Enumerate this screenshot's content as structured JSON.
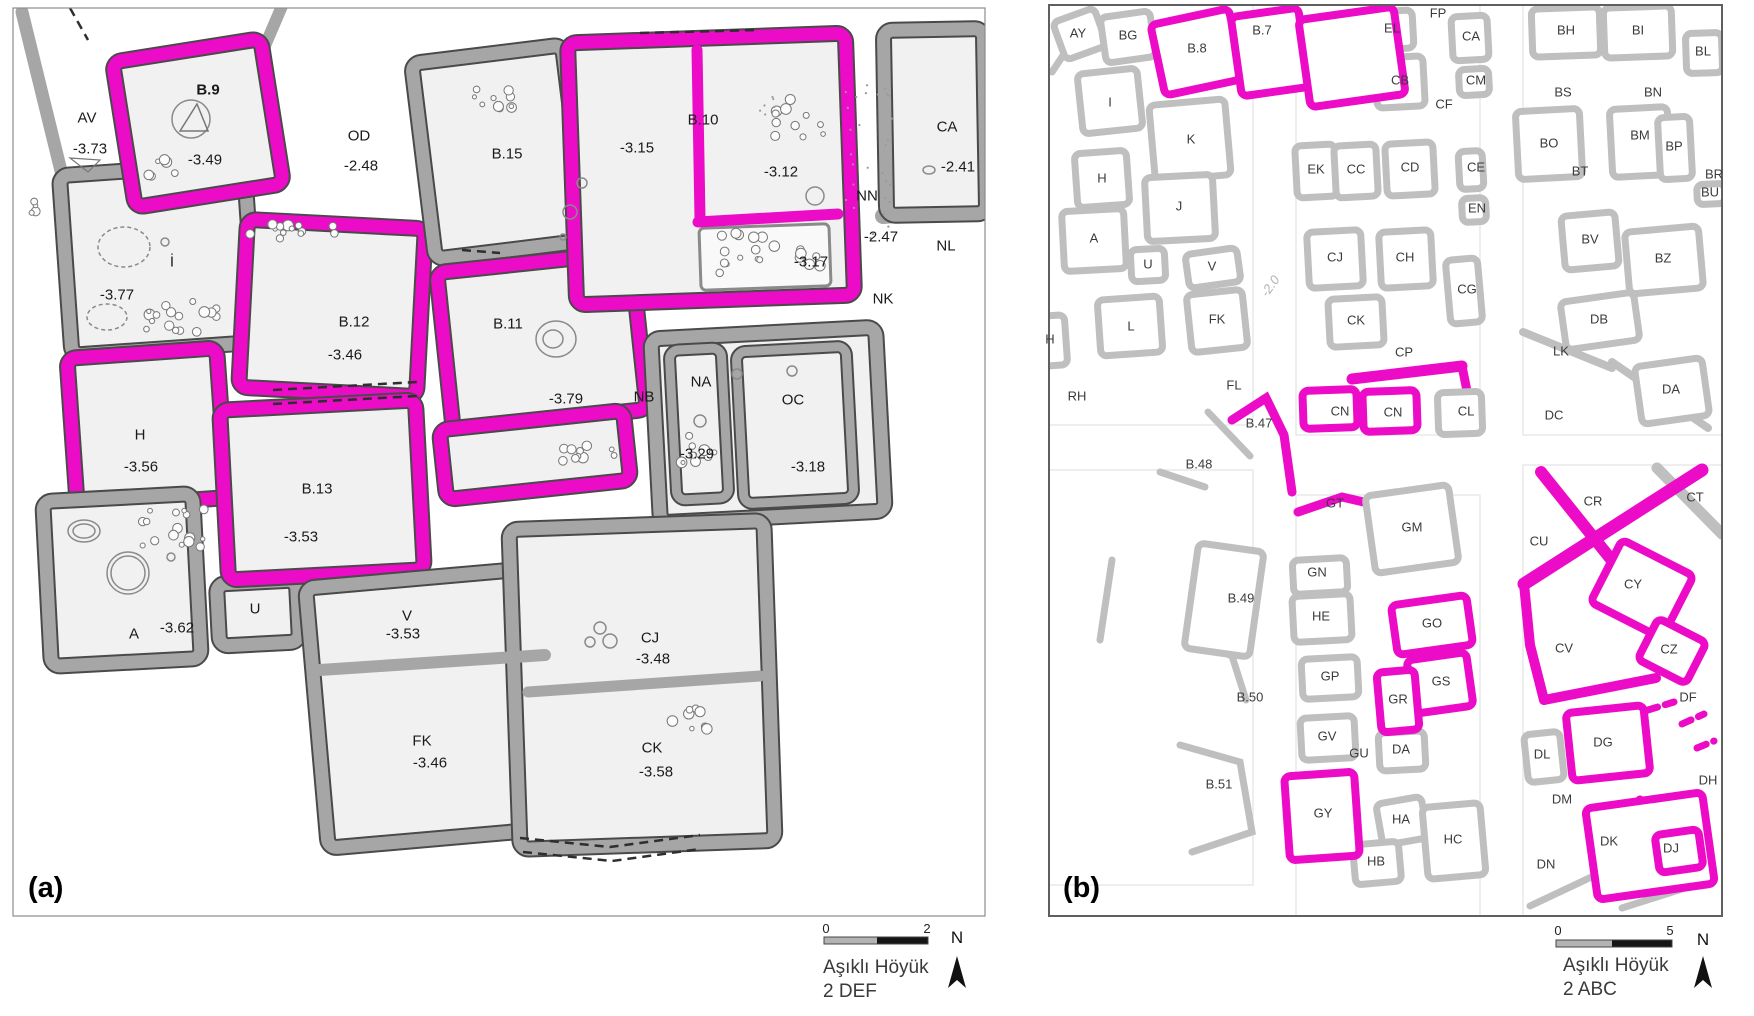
{
  "panel_a": {
    "tag": "(a)",
    "labels": [
      {
        "t": "AV",
        "x": 87,
        "y": 118
      },
      {
        "t": "-3.73",
        "x": 90,
        "y": 149
      },
      {
        "t": "B.9",
        "x": 208,
        "y": 90,
        "bold": true
      },
      {
        "t": "-3.49",
        "x": 205,
        "y": 160
      },
      {
        "t": "OD",
        "x": 359,
        "y": 136
      },
      {
        "t": "-2.48",
        "x": 361,
        "y": 166
      },
      {
        "t": "B.15",
        "x": 507,
        "y": 154
      },
      {
        "t": "-3.15",
        "x": 637,
        "y": 148
      },
      {
        "t": "B.10",
        "x": 703,
        "y": 120
      },
      {
        "t": "-3.12",
        "x": 781,
        "y": 172
      },
      {
        "t": "CA",
        "x": 947,
        "y": 127
      },
      {
        "t": "-2.41",
        "x": 958,
        "y": 167
      },
      {
        "t": "NN",
        "x": 867,
        "y": 196
      },
      {
        "t": "-2.47",
        "x": 881,
        "y": 237
      },
      {
        "t": "NL",
        "x": 946,
        "y": 246
      },
      {
        "t": "-3.17",
        "x": 811,
        "y": 262
      },
      {
        "t": "NK",
        "x": 883,
        "y": 299
      },
      {
        "t": "İ",
        "x": 172,
        "y": 262
      },
      {
        "t": "-3.77",
        "x": 117,
        "y": 295
      },
      {
        "t": "B.12",
        "x": 354,
        "y": 322
      },
      {
        "t": "-3.46",
        "x": 345,
        "y": 355
      },
      {
        "t": "B.11",
        "x": 508,
        "y": 324
      },
      {
        "t": "-3.79",
        "x": 566,
        "y": 399
      },
      {
        "t": "NB",
        "x": 644,
        "y": 397
      },
      {
        "t": "NA",
        "x": 701,
        "y": 382
      },
      {
        "t": "-3.29",
        "x": 697,
        "y": 454
      },
      {
        "t": "OC",
        "x": 793,
        "y": 400
      },
      {
        "t": "-3.18",
        "x": 808,
        "y": 467
      },
      {
        "t": "H",
        "x": 140,
        "y": 435
      },
      {
        "t": "-3.56",
        "x": 141,
        "y": 467
      },
      {
        "t": "B.13",
        "x": 317,
        "y": 489
      },
      {
        "t": "-3.53",
        "x": 301,
        "y": 537
      },
      {
        "t": "A",
        "x": 134,
        "y": 634
      },
      {
        "t": "-3.62",
        "x": 177,
        "y": 628
      },
      {
        "t": "U",
        "x": 255,
        "y": 609
      },
      {
        "t": "V",
        "x": 407,
        "y": 616
      },
      {
        "t": "-3.53",
        "x": 403,
        "y": 634
      },
      {
        "t": "FK",
        "x": 422,
        "y": 741
      },
      {
        "t": "-3.46",
        "x": 430,
        "y": 763
      },
      {
        "t": "CJ",
        "x": 650,
        "y": 638
      },
      {
        "t": "-3.48",
        "x": 653,
        "y": 659
      },
      {
        "t": "CK",
        "x": 652,
        "y": 748
      },
      {
        "t": "-3.58",
        "x": 656,
        "y": 772
      }
    ],
    "scalebar": {
      "tick_start": "0",
      "tick_end": "2",
      "line1": "Aşıklı Höyük",
      "line2": "2 DEF",
      "north": "N"
    }
  },
  "panel_b": {
    "tag": "(b)",
    "labels": [
      {
        "t": "AY",
        "x": 1078,
        "y": 33
      },
      {
        "t": "BG",
        "x": 1128,
        "y": 35
      },
      {
        "t": "B.8",
        "x": 1197,
        "y": 48
      },
      {
        "t": "B.7",
        "x": 1262,
        "y": 30
      },
      {
        "t": "EL",
        "x": 1392,
        "y": 28
      },
      {
        "t": "FP",
        "x": 1438,
        "y": 13
      },
      {
        "t": "CA",
        "x": 1471,
        "y": 36
      },
      {
        "t": "CB",
        "x": 1400,
        "y": 80
      },
      {
        "t": "CM",
        "x": 1476,
        "y": 80
      },
      {
        "t": "CF",
        "x": 1444,
        "y": 104
      },
      {
        "t": "CE",
        "x": 1476,
        "y": 167
      },
      {
        "t": "EN",
        "x": 1477,
        "y": 208
      },
      {
        "t": "CG",
        "x": 1467,
        "y": 289
      },
      {
        "t": "I",
        "x": 1110,
        "y": 102
      },
      {
        "t": "K",
        "x": 1191,
        "y": 139
      },
      {
        "t": "H",
        "x": 1102,
        "y": 178
      },
      {
        "t": "J",
        "x": 1179,
        "y": 206
      },
      {
        "t": "A",
        "x": 1094,
        "y": 238
      },
      {
        "t": "U",
        "x": 1148,
        "y": 264
      },
      {
        "t": "V",
        "x": 1212,
        "y": 266
      },
      {
        "t": "L",
        "x": 1131,
        "y": 326
      },
      {
        "t": "H",
        "x": 1050,
        "y": 339
      },
      {
        "t": "FK",
        "x": 1217,
        "y": 319
      },
      {
        "t": "RH",
        "x": 1077,
        "y": 396
      },
      {
        "t": "FL",
        "x": 1234,
        "y": 385
      },
      {
        "t": "-2.0",
        "x": 1270,
        "y": 286,
        "rot": -55,
        "muted": true
      },
      {
        "t": "B.47",
        "x": 1259,
        "y": 423
      },
      {
        "t": "B.48",
        "x": 1199,
        "y": 464
      },
      {
        "t": "B.49",
        "x": 1241,
        "y": 598
      },
      {
        "t": "B.50",
        "x": 1250,
        "y": 697
      },
      {
        "t": "B.51",
        "x": 1219,
        "y": 784
      },
      {
        "t": "EK",
        "x": 1316,
        "y": 169
      },
      {
        "t": "CC",
        "x": 1356,
        "y": 169
      },
      {
        "t": "CD",
        "x": 1410,
        "y": 167
      },
      {
        "t": "CJ",
        "x": 1335,
        "y": 257
      },
      {
        "t": "CH",
        "x": 1405,
        "y": 257
      },
      {
        "t": "CK",
        "x": 1356,
        "y": 320
      },
      {
        "t": "CP",
        "x": 1404,
        "y": 352
      },
      {
        "t": "CN",
        "x": 1340,
        "y": 411
      },
      {
        "t": "CN",
        "x": 1393,
        "y": 412
      },
      {
        "t": "CL",
        "x": 1466,
        "y": 411
      },
      {
        "t": "BH",
        "x": 1566,
        "y": 30
      },
      {
        "t": "BI",
        "x": 1638,
        "y": 30
      },
      {
        "t": "BL",
        "x": 1703,
        "y": 51
      },
      {
        "t": "BS",
        "x": 1563,
        "y": 92
      },
      {
        "t": "BN",
        "x": 1653,
        "y": 92
      },
      {
        "t": "BO",
        "x": 1549,
        "y": 143
      },
      {
        "t": "BM",
        "x": 1640,
        "y": 135
      },
      {
        "t": "BP",
        "x": 1674,
        "y": 146
      },
      {
        "t": "BT",
        "x": 1580,
        "y": 171
      },
      {
        "t": "BR",
        "x": 1714,
        "y": 174
      },
      {
        "t": "BU",
        "x": 1710,
        "y": 192
      },
      {
        "t": "BV",
        "x": 1590,
        "y": 239
      },
      {
        "t": "BZ",
        "x": 1663,
        "y": 258
      },
      {
        "t": "DB",
        "x": 1599,
        "y": 319
      },
      {
        "t": "LK",
        "x": 1561,
        "y": 351
      },
      {
        "t": "DA",
        "x": 1671,
        "y": 389
      },
      {
        "t": "DC",
        "x": 1554,
        "y": 415
      },
      {
        "t": "GT",
        "x": 1335,
        "y": 503
      },
      {
        "t": "GM",
        "x": 1412,
        "y": 527
      },
      {
        "t": "GN",
        "x": 1317,
        "y": 572
      },
      {
        "t": "HE",
        "x": 1321,
        "y": 616
      },
      {
        "t": "GO",
        "x": 1432,
        "y": 623
      },
      {
        "t": "GP",
        "x": 1330,
        "y": 676
      },
      {
        "t": "GS",
        "x": 1441,
        "y": 681
      },
      {
        "t": "GR",
        "x": 1398,
        "y": 699
      },
      {
        "t": "GV",
        "x": 1327,
        "y": 736
      },
      {
        "t": "GU",
        "x": 1359,
        "y": 753
      },
      {
        "t": "DA",
        "x": 1401,
        "y": 749
      },
      {
        "t": "GY",
        "x": 1323,
        "y": 813
      },
      {
        "t": "HA",
        "x": 1401,
        "y": 819
      },
      {
        "t": "HB",
        "x": 1376,
        "y": 861
      },
      {
        "t": "HC",
        "x": 1453,
        "y": 839
      },
      {
        "t": "CR",
        "x": 1593,
        "y": 501
      },
      {
        "t": "CT",
        "x": 1695,
        "y": 497
      },
      {
        "t": "CU",
        "x": 1539,
        "y": 541
      },
      {
        "t": "CY",
        "x": 1633,
        "y": 584
      },
      {
        "t": "CV",
        "x": 1564,
        "y": 648
      },
      {
        "t": "CZ",
        "x": 1669,
        "y": 649
      },
      {
        "t": "DF",
        "x": 1688,
        "y": 697
      },
      {
        "t": "DG",
        "x": 1603,
        "y": 742
      },
      {
        "t": "DL",
        "x": 1542,
        "y": 754
      },
      {
        "t": "DH",
        "x": 1708,
        "y": 780
      },
      {
        "t": "DM",
        "x": 1562,
        "y": 799
      },
      {
        "t": "DK",
        "x": 1609,
        "y": 841
      },
      {
        "t": "DJ",
        "x": 1671,
        "y": 848
      },
      {
        "t": "DN",
        "x": 1546,
        "y": 864
      }
    ],
    "scalebar": {
      "tick_start": "0",
      "tick_end": "5",
      "line1": "Aşıklı Höyük",
      "line2": "2 ABC",
      "north": "N"
    }
  },
  "colors": {
    "highlight": "#ec0bc6",
    "wall_gray": "#a6a6a6",
    "wall_dark_edge": "#4a4a4a",
    "wall_gray_b": "#bfbfbf",
    "room_fill": "#f1f1f1",
    "frame_a": "#8c8c8c",
    "frame_b": "#5f5f5f",
    "scalebar_gray": "#b3b3b3",
    "scalebar_black": "#151515"
  }
}
